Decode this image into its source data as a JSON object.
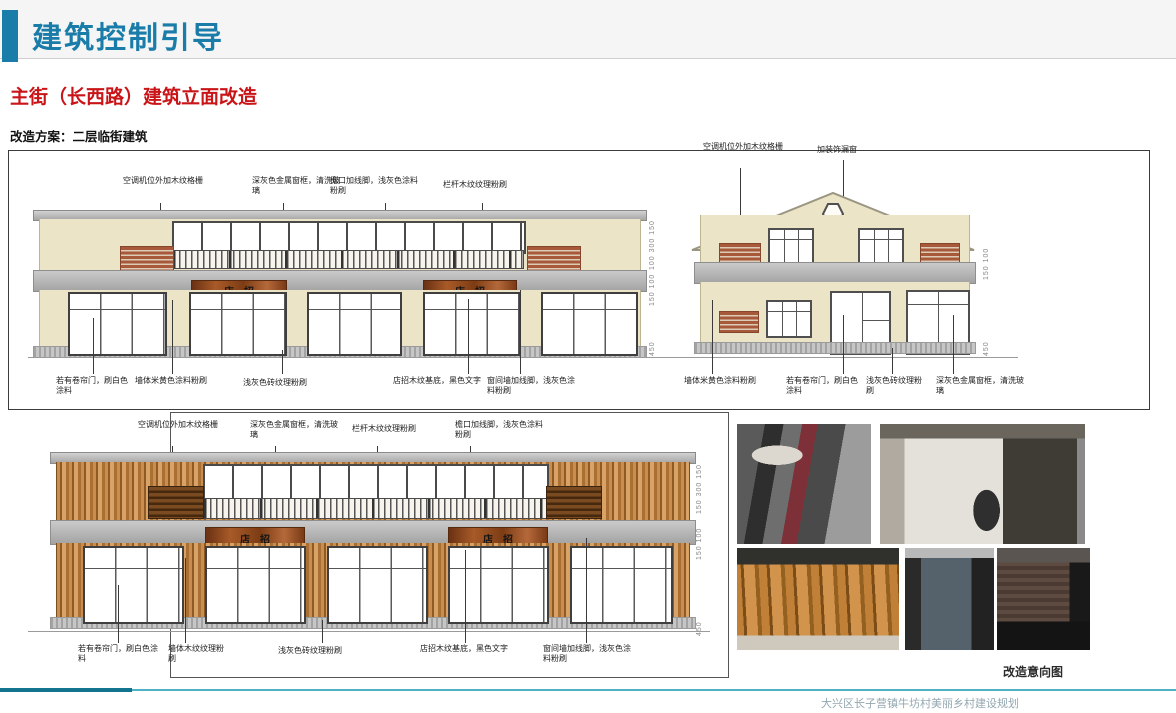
{
  "page": {
    "title": "建筑控制引导",
    "section_title": "主街（长西路）建筑立面改造",
    "scheme_label": "改造方案：二层临街建筑"
  },
  "colors": {
    "accent_teal": "#1a7ca8",
    "heading_red": "#c91418",
    "wall_beige": "#ece4c6",
    "band_gray": "#a9a9a9",
    "brick_red": "#a8593a",
    "wood_brown": "#b17336",
    "footer_teal": "#4cb2c4"
  },
  "flat_elevation": {
    "top_annotations": [
      "空调机位外加木纹格栅",
      "深灰色金属窗框，清洗玻璃",
      "檐口加线脚，浅灰色涂料粉刷",
      "栏杆木纹纹理粉刷"
    ],
    "bottom_annotations": [
      "若有卷帘门，刷白色涂料",
      "墙体米黄色涂料粉刷",
      "浅灰色砖纹理粉刷",
      "店招木纹基底，黑色文字",
      "窗间墙加线脚，浅灰色涂料粉刷"
    ],
    "sign_text": "店招",
    "dims": [
      "100 300 150",
      "150 100",
      "450"
    ]
  },
  "gable_elevation": {
    "top_annotations": [
      "空调机位外加木纹格栅",
      "加装饰漏窗"
    ],
    "bottom_annotations": [
      "墙体米黄色涂料粉刷",
      "若有卷帘门，刷白色涂料",
      "浅灰色砖纹理粉刷",
      "深灰色金属窗框，清洗玻璃"
    ],
    "dims": [
      "150 100",
      "450"
    ]
  },
  "wood_elevation": {
    "top_annotations": [
      "空调机位外加木纹格栅",
      "深灰色金属窗框，清洗玻璃",
      "栏杆木纹纹理粉刷",
      "檐口加线脚，浅灰色涂料粉刷"
    ],
    "bottom_annotations": [
      "若有卷帘门，刷白色涂料",
      "墙体木纹纹理粉刷",
      "浅灰色砖纹理粉刷",
      "店招木纹基底，黑色文字",
      "窗间墙加线脚，浅灰色涂料粉刷"
    ],
    "sign_text": "店招",
    "dims": [
      "150 300 150",
      "150 100",
      "450"
    ]
  },
  "photos": {
    "caption": "改造意向图"
  },
  "footer": {
    "text": "大兴区长子营镇牛坊村美丽乡村建设规划"
  }
}
